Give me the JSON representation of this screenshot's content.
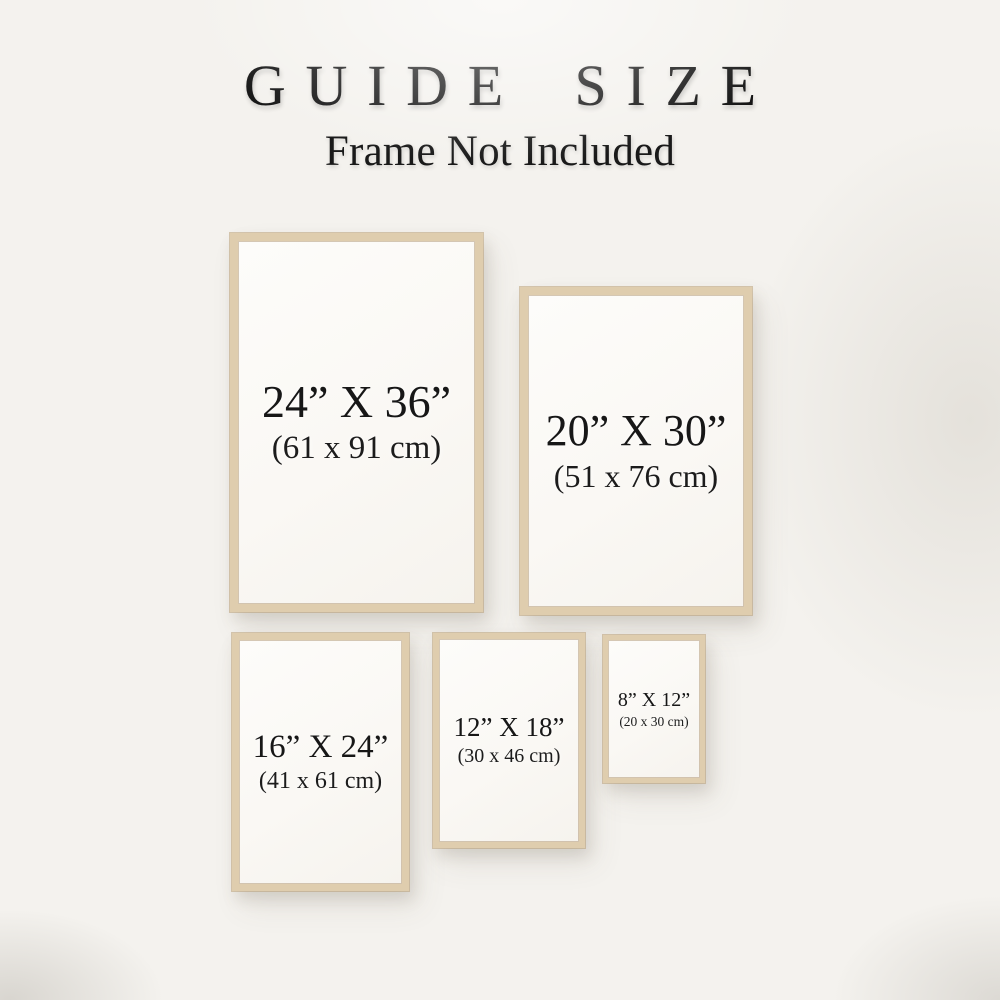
{
  "page": {
    "title": "GUIDE SIZE",
    "subtitle": "Frame Not Included"
  },
  "frames": [
    {
      "name": "24x36",
      "inches": "24” X 36”",
      "centimeters": "(61 x 91 cm)"
    },
    {
      "name": "20x30",
      "inches": "20” X 30”",
      "centimeters": "(51 x 76 cm)"
    },
    {
      "name": "16x24",
      "inches": "16” X 24”",
      "centimeters": "(41 x 61 cm)"
    },
    {
      "name": "12x18",
      "inches": "12” X 18”",
      "centimeters": "(30 x 46 cm)"
    },
    {
      "name": "8x12",
      "inches": "8” X 12”",
      "centimeters": "(20 x 30 cm)"
    }
  ],
  "colors": {
    "background": "#f4f2ee",
    "frame_wood": "#dfcdae",
    "text": "#171717"
  }
}
